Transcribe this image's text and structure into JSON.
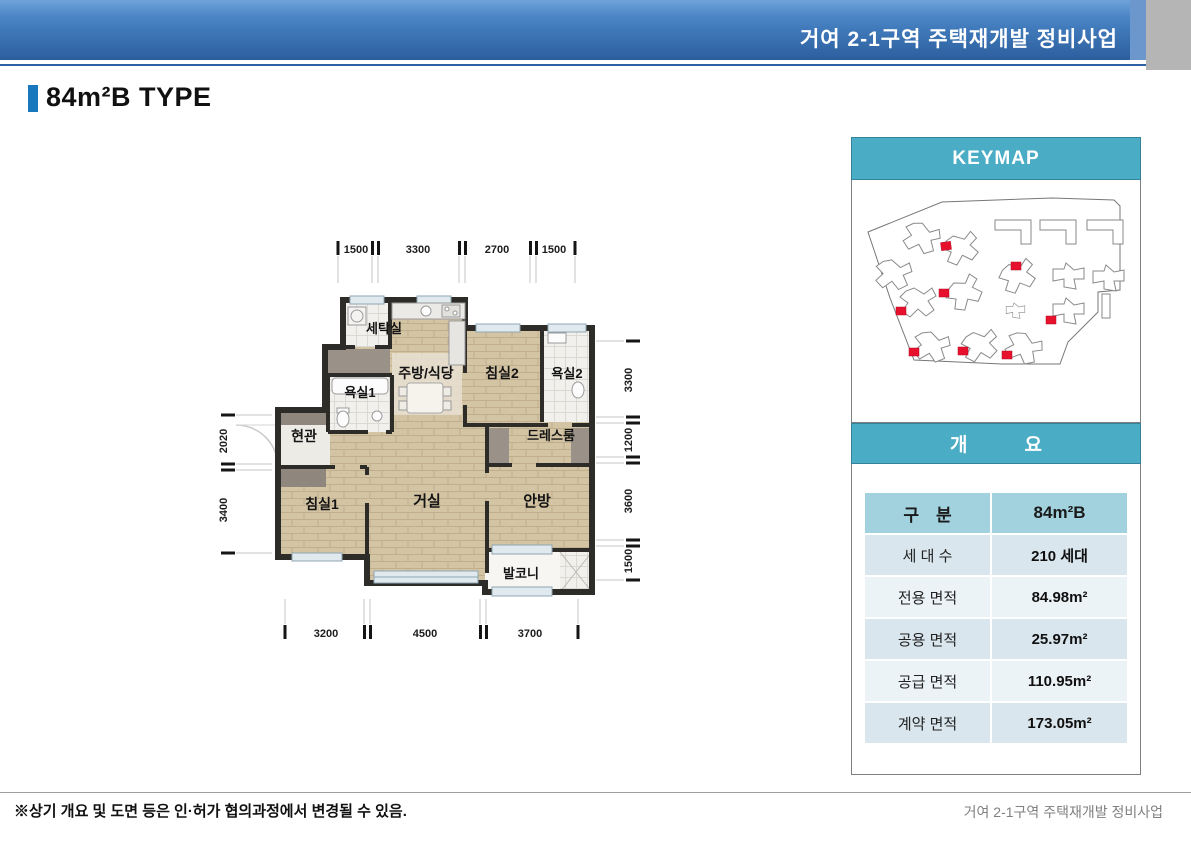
{
  "header": {
    "project_title": "거여 2-1구역 주택재개발 정비사업"
  },
  "page": {
    "title": "84m²B TYPE"
  },
  "floor_plan": {
    "rooms": [
      "세탁실",
      "주방/식당",
      "침실2",
      "욕실2",
      "욕실1",
      "현관",
      "드레스룸",
      "침실1",
      "거실",
      "안방",
      "발코니"
    ],
    "dims_top": [
      "1500",
      "3300",
      "2700",
      "1500"
    ],
    "dims_bottom": [
      "3200",
      "4500",
      "3700"
    ],
    "dims_left": [
      "2020",
      "3400"
    ],
    "dims_right": [
      "3300",
      "1200",
      "3600",
      "1500"
    ]
  },
  "keymap": {
    "title": "KEYMAP"
  },
  "overview": {
    "title": "개　　　요",
    "table": {
      "header": {
        "label": "구　분",
        "value": "84m²B"
      },
      "rows": [
        {
          "label": "세 대 수",
          "value": "210 세대"
        },
        {
          "label": "전용 면적",
          "value": "84.98m²"
        },
        {
          "label": "공용 면적",
          "value": "25.97m²"
        },
        {
          "label": "공급 면적",
          "value": "110.95m²"
        },
        {
          "label": "계약 면적",
          "value": "173.05m²"
        }
      ]
    }
  },
  "footer": {
    "note": "※상기 개요 및 도면 등은 인·허가 협의과정에서 변경될 수 있음.",
    "project": "거여 2-1구역 주택재개발 정비사업"
  },
  "colors": {
    "header_blue_top": "#6ea3da",
    "header_blue_bottom": "#2c5e9e",
    "accent_blue": "#1878BE",
    "panel_teal": "#4BACC6",
    "table_head": "#A3D2DF",
    "table_row_dark": "#D9E6ED",
    "table_row_light": "#ECF3F7",
    "keymap_marker_red": "#E8112D",
    "wall": "#2e2c29",
    "wood_floor": "#d3c4a4"
  }
}
